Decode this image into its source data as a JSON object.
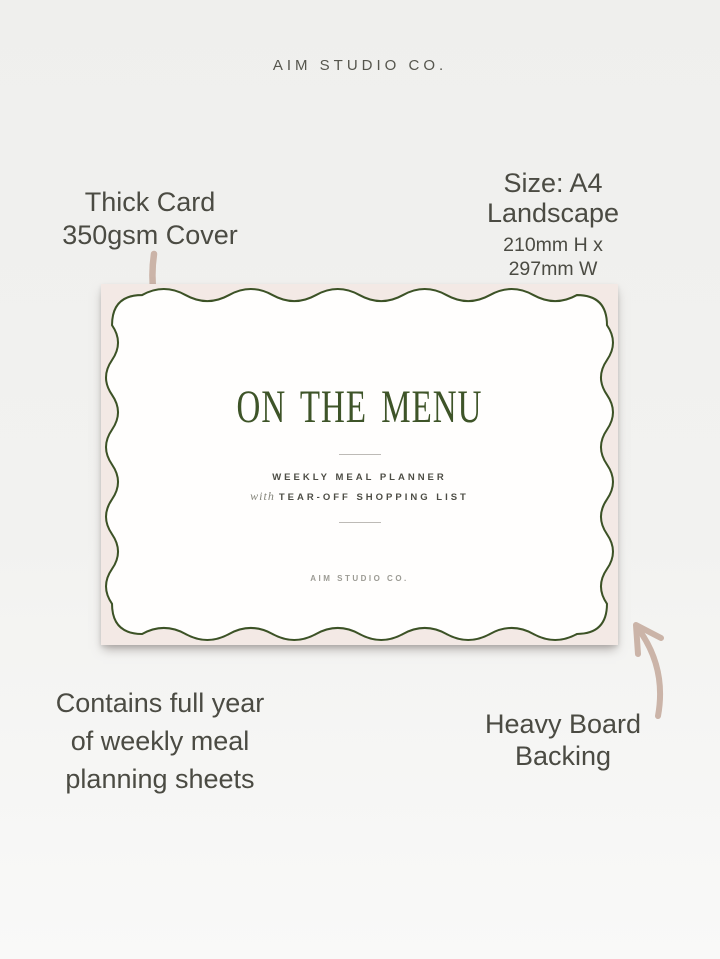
{
  "page": {
    "background": "#f0f0ee",
    "brand_header": "AIM STUDIO CO."
  },
  "annotations": {
    "material": {
      "line1": "Thick Card",
      "line2": "350gsm Cover"
    },
    "size": {
      "title": "Size: A4 Landscape",
      "dimensions": "210mm H x 297mm W"
    },
    "contents": {
      "line1": "Contains full year",
      "line2": "of weekly meal",
      "line3": "planning sheets"
    },
    "backing": {
      "line1": "Heavy Board",
      "line2": "Backing"
    }
  },
  "card": {
    "title": "ON THE MENU",
    "tagline_line1": "WEEKLY MEAL PLANNER",
    "tagline_line2_prefix": "with",
    "tagline_line2_text": "TEAR-OFF SHOPPING LIST",
    "brand_footer": "AIM STUDIO CO.",
    "colors": {
      "mat_pink": "#f3e9e5",
      "border_green": "#3c5226",
      "title_green": "#3e5428",
      "inner_white": "#fffefd"
    }
  },
  "arrows": {
    "color": "#cbb4a8"
  }
}
